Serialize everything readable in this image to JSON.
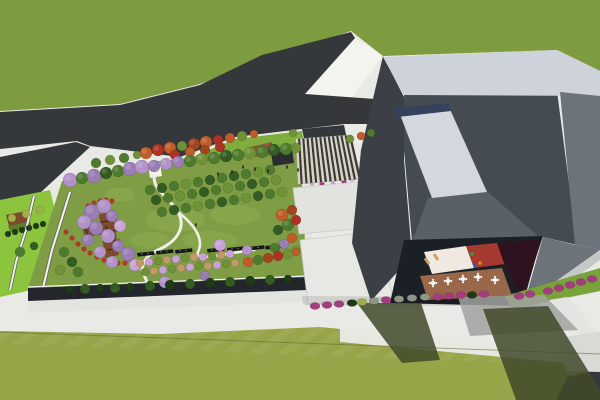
{
  "scene": {
    "palette": {
      "lawnTop": "#7d9b3f",
      "lawnBottom": "#8d9c40",
      "gardenLawn": "#7f9d45",
      "parkGreen": "#8cc43e",
      "stripGreen": "#7fae3f",
      "rightStripGreen": "#7aa23a",
      "road": "#35383b",
      "hardscape": "#e9e9e5",
      "brightPaving": "#f3f3ef",
      "path": "#f0efe8",
      "pathDark": "#5a5a56",
      "parapetDark": "#23272b",
      "wallLight": "#e3e4df",
      "buildingTop": "#cdd2db",
      "buildingFaceDark": "#3a4046",
      "buildingInner": "#454b53",
      "buildingSlope": "#6d737b",
      "underSkylight": "#5a6068",
      "skylight": "#d4d7de",
      "skylightStrip": "#34425d",
      "eave": "#c4c8c7",
      "courtyardSurround": "#1b2026",
      "courtyardWhite": "#efe9e2",
      "courtyardRed": "#a63a31",
      "courtyardMaroon": "#2e1220",
      "terraceBrown": "#99684a",
      "pergolaBrown": "#7c4c2a",
      "pergolaSlat": "#3a2414",
      "amphiBrown": "#8a5a34",
      "kioskDark": "#2a2d30",
      "canopyDark": "#3a3a38",
      "canopyLight": "#d8d4c4",
      "memorial": "#15181a",
      "shadowGrass": "#3f4a2a",
      "shadowPaving": "#a0a2a0",
      "tableWhite": "#f5f5f2",
      "loungerTan": "#c8a06a",
      "personDark": "#26262a",
      "flowerRed": "#b03226",
      "lawnPatch": "#93b052",
      "g1": "#4e7a2e",
      "g2": "#335c22",
      "g3": "#6f9138",
      "g4": "#9ab14e",
      "p1": "#9b7db6",
      "p2": "#b392c9",
      "pk": "#c9a2d8",
      "mg": "#a63c80",
      "o1": "#c05c28",
      "o2": "#a0441e",
      "rd": "#ae3224",
      "tn": "#c09a6a",
      "gy": "#8e9682",
      "yg": "#a2b04c",
      "hd": "#1e3a16"
    },
    "trees": [
      [
        96,
        163,
        5,
        "g1"
      ],
      [
        110,
        160,
        5,
        "g3"
      ],
      [
        124,
        158,
        5,
        "g1"
      ],
      [
        137,
        155,
        4,
        "g3"
      ],
      [
        146,
        153,
        6,
        "o1"
      ],
      [
        158,
        150,
        6,
        "rd"
      ],
      [
        170,
        148,
        6,
        "o1"
      ],
      [
        182,
        146,
        5,
        "g3"
      ],
      [
        194,
        144,
        6,
        "o2"
      ],
      [
        206,
        142,
        6,
        "o1"
      ],
      [
        218,
        140,
        5,
        "rd"
      ],
      [
        230,
        138,
        5,
        "o1"
      ],
      [
        242,
        136,
        5,
        "g3"
      ],
      [
        254,
        134,
        4,
        "o1"
      ],
      [
        175,
        155,
        5,
        "rd"
      ],
      [
        190,
        152,
        5,
        "o1"
      ],
      [
        205,
        150,
        5,
        "o2"
      ],
      [
        220,
        147,
        5,
        "rd"
      ],
      [
        293,
        133,
        4,
        "g3"
      ],
      [
        350,
        139,
        4,
        "g3"
      ],
      [
        361,
        136,
        4,
        "o1"
      ],
      [
        371,
        133,
        4,
        "g1"
      ],
      [
        70,
        180,
        7,
        "p2"
      ],
      [
        82,
        178,
        6,
        "g1"
      ],
      [
        94,
        176,
        7,
        "p1"
      ],
      [
        106,
        173,
        6,
        "g2"
      ],
      [
        118,
        171,
        6,
        "g1"
      ],
      [
        130,
        169,
        7,
        "p1"
      ],
      [
        142,
        167,
        7,
        "p2"
      ],
      [
        154,
        166,
        6,
        "p1"
      ],
      [
        166,
        164,
        6,
        "p2"
      ],
      [
        178,
        162,
        6,
        "p1"
      ],
      [
        190,
        161,
        6,
        "g1"
      ],
      [
        202,
        159,
        6,
        "g3"
      ],
      [
        214,
        158,
        6,
        "g1"
      ],
      [
        226,
        156,
        6,
        "g2"
      ],
      [
        238,
        155,
        6,
        "g1"
      ],
      [
        250,
        153,
        6,
        "g3"
      ],
      [
        262,
        152,
        6,
        "g1"
      ],
      [
        274,
        150,
        6,
        "g2"
      ],
      [
        286,
        149,
        6,
        "g1"
      ],
      [
        296,
        148,
        5,
        "g3"
      ],
      [
        150,
        190,
        5,
        "g1"
      ],
      [
        162,
        188,
        5,
        "g2"
      ],
      [
        174,
        186,
        5,
        "g1"
      ],
      [
        186,
        184,
        5,
        "g3"
      ],
      [
        198,
        182,
        5,
        "g1"
      ],
      [
        210,
        180,
        5,
        "g2"
      ],
      [
        222,
        178,
        5,
        "g1"
      ],
      [
        234,
        176,
        5,
        "g2"
      ],
      [
        246,
        174,
        5,
        "g1"
      ],
      [
        258,
        172,
        5,
        "g3"
      ],
      [
        270,
        170,
        5,
        "g1"
      ],
      [
        156,
        200,
        5,
        "g2"
      ],
      [
        168,
        198,
        5,
        "g1"
      ],
      [
        180,
        196,
        5,
        "g3"
      ],
      [
        192,
        194,
        5,
        "g1"
      ],
      [
        204,
        192,
        5,
        "g2"
      ],
      [
        216,
        190,
        5,
        "g1"
      ],
      [
        228,
        188,
        5,
        "g3"
      ],
      [
        240,
        186,
        5,
        "g1"
      ],
      [
        252,
        184,
        5,
        "g2"
      ],
      [
        264,
        182,
        5,
        "g1"
      ],
      [
        276,
        180,
        5,
        "g3"
      ],
      [
        162,
        212,
        5,
        "g1"
      ],
      [
        174,
        210,
        5,
        "g2"
      ],
      [
        186,
        208,
        5,
        "g1"
      ],
      [
        198,
        206,
        5,
        "g3"
      ],
      [
        210,
        204,
        5,
        "g1"
      ],
      [
        222,
        202,
        5,
        "g2"
      ],
      [
        234,
        200,
        5,
        "g1"
      ],
      [
        246,
        198,
        5,
        "g3"
      ],
      [
        258,
        196,
        5,
        "g2"
      ],
      [
        270,
        194,
        5,
        "g1"
      ],
      [
        282,
        192,
        5,
        "g3"
      ],
      [
        282,
        215,
        6,
        "o1"
      ],
      [
        292,
        210,
        5,
        "o2"
      ],
      [
        288,
        225,
        6,
        "g1"
      ],
      [
        296,
        220,
        5,
        "rd"
      ],
      [
        278,
        230,
        5,
        "g2"
      ],
      [
        292,
        238,
        5,
        "o1"
      ],
      [
        284,
        244,
        5,
        "p1"
      ],
      [
        296,
        250,
        4,
        "g3"
      ],
      [
        275,
        248,
        5,
        "g1"
      ],
      [
        92,
        212,
        8,
        "p1"
      ],
      [
        104,
        206,
        7,
        "p2"
      ],
      [
        84,
        222,
        7,
        "p2"
      ],
      [
        112,
        216,
        6,
        "p1"
      ],
      [
        96,
        228,
        7,
        "p1"
      ],
      [
        120,
        226,
        6,
        "pk"
      ],
      [
        108,
        236,
        7,
        "p2"
      ],
      [
        88,
        240,
        6,
        "p1"
      ],
      [
        118,
        246,
        6,
        "p1"
      ],
      [
        100,
        252,
        6,
        "p2"
      ],
      [
        128,
        254,
        7,
        "p1"
      ],
      [
        112,
        262,
        6,
        "p2"
      ],
      [
        135,
        265,
        6,
        "pk"
      ],
      [
        64,
        252,
        5,
        "g1"
      ],
      [
        72,
        262,
        5,
        "g2"
      ],
      [
        60,
        270,
        5,
        "g3"
      ],
      [
        78,
        272,
        5,
        "g1"
      ],
      [
        140,
        263,
        4,
        "tn"
      ],
      [
        149,
        262,
        4,
        "pk"
      ],
      [
        158,
        261,
        4,
        "g3"
      ],
      [
        167,
        260,
        4,
        "tn"
      ],
      [
        176,
        259,
        4,
        "pk"
      ],
      [
        185,
        258,
        4,
        "g3"
      ],
      [
        194,
        257,
        4,
        "tn"
      ],
      [
        203,
        257,
        4,
        "pk"
      ],
      [
        212,
        256,
        4,
        "g3"
      ],
      [
        221,
        255,
        4,
        "tn"
      ],
      [
        230,
        254,
        4,
        "pk"
      ],
      [
        145,
        272,
        4,
        "g3"
      ],
      [
        154,
        271,
        4,
        "tn"
      ],
      [
        163,
        270,
        4,
        "pk"
      ],
      [
        172,
        269,
        4,
        "g3"
      ],
      [
        181,
        268,
        4,
        "tn"
      ],
      [
        190,
        267,
        4,
        "pk"
      ],
      [
        199,
        266,
        4,
        "g3"
      ],
      [
        208,
        266,
        4,
        "tn"
      ],
      [
        217,
        265,
        4,
        "pk"
      ],
      [
        226,
        264,
        4,
        "g3"
      ],
      [
        235,
        263,
        4,
        "tn"
      ],
      [
        248,
        262,
        5,
        "o1"
      ],
      [
        258,
        260,
        5,
        "g1"
      ],
      [
        268,
        258,
        5,
        "o2"
      ],
      [
        278,
        256,
        5,
        "rd"
      ],
      [
        288,
        254,
        5,
        "g3"
      ],
      [
        296,
        252,
        4,
        "o1"
      ],
      [
        165,
        282,
        6,
        "p2"
      ],
      [
        205,
        276,
        5,
        "p1"
      ],
      [
        220,
        245,
        6,
        "pk"
      ],
      [
        247,
        250,
        5,
        "p2"
      ],
      [
        70,
        290,
        4,
        "hd"
      ],
      [
        85,
        289,
        5,
        "g2"
      ],
      [
        100,
        288,
        4,
        "hd"
      ],
      [
        115,
        288,
        5,
        "g2"
      ],
      [
        130,
        287,
        4,
        "hd"
      ],
      [
        150,
        286,
        5,
        "g2"
      ],
      [
        170,
        285,
        5,
        "hd"
      ],
      [
        190,
        284,
        5,
        "g2"
      ],
      [
        210,
        283,
        5,
        "hd"
      ],
      [
        230,
        282,
        5,
        "g2"
      ],
      [
        250,
        281,
        5,
        "hd"
      ],
      [
        270,
        280,
        5,
        "g2"
      ],
      [
        288,
        279,
        4,
        "hd"
      ],
      [
        20,
        252,
        5,
        "g1"
      ],
      [
        34,
        246,
        4,
        "g2"
      ],
      [
        12,
        218,
        4,
        "yg"
      ],
      [
        8,
        234,
        3,
        "hd"
      ],
      [
        15,
        232,
        3,
        "hd"
      ],
      [
        22,
        230,
        3,
        "hd"
      ],
      [
        29,
        228,
        3,
        "hd"
      ],
      [
        36,
        226,
        3,
        "hd"
      ],
      [
        43,
        224,
        3,
        "hd"
      ],
      [
        26,
        214,
        4,
        "yg"
      ],
      [
        40,
        210,
        4,
        "yg"
      ]
    ],
    "apron_shrubs": [
      [
        315,
        306,
        "mg"
      ],
      [
        327,
        305,
        "mg"
      ],
      [
        339,
        304,
        "mg"
      ],
      [
        352,
        303,
        "hd"
      ],
      [
        362,
        302,
        "yg"
      ],
      [
        374,
        301,
        "gy"
      ],
      [
        386,
        300,
        "mg"
      ],
      [
        399,
        299,
        "gy"
      ],
      [
        412,
        298,
        "gy"
      ],
      [
        425,
        297,
        "gy"
      ],
      [
        438,
        297,
        "mg"
      ],
      [
        449,
        296,
        "mg"
      ],
      [
        461,
        295,
        "mg"
      ],
      [
        472,
        295,
        "hd"
      ],
      [
        484,
        294,
        "mg"
      ],
      [
        519,
        296,
        "mg"
      ],
      [
        530,
        294,
        "mg"
      ],
      [
        548,
        291,
        "mg"
      ],
      [
        559,
        288,
        "mg"
      ],
      [
        570,
        285,
        "mg"
      ],
      [
        581,
        282,
        "mg"
      ],
      [
        592,
        279,
        "mg"
      ]
    ],
    "memorial_walls": [
      [
        137,
        253
      ],
      [
        156,
        251
      ],
      [
        175,
        250
      ],
      [
        207,
        249
      ],
      [
        227,
        248
      ],
      [
        247,
        247
      ],
      [
        265,
        246
      ]
    ],
    "canopy": {
      "tl": [
        296,
        139
      ],
      "tr": [
        351,
        135
      ],
      "br": [
        361,
        179
      ],
      "bl": [
        298,
        184
      ],
      "stripes": 26
    },
    "tables": [
      [
        433,
        283
      ],
      [
        448,
        281
      ],
      [
        463,
        279
      ],
      [
        478,
        277
      ],
      [
        495,
        280
      ]
    ],
    "loungers": [
      [
        427,
        261
      ],
      [
        436,
        257
      ]
    ],
    "people_plaza": [
      [
        243,
        167
      ],
      [
        255,
        169
      ],
      [
        268,
        171
      ],
      [
        287,
        167
      ],
      [
        298,
        170
      ],
      [
        232,
        172
      ],
      [
        218,
        174
      ],
      [
        196,
        225
      ]
    ],
    "people_courtyard": [
      [
        472,
        254,
        "#3aa03a"
      ],
      [
        477,
        258,
        "#c03030"
      ],
      [
        480,
        263,
        "#d89020"
      ],
      [
        475,
        266,
        "#3558b8"
      ]
    ],
    "flowers_red": [
      [
        66,
        232
      ],
      [
        72,
        238
      ],
      [
        78,
        244
      ],
      [
        84,
        249
      ],
      [
        90,
        253
      ],
      [
        97,
        257
      ],
      [
        104,
        260
      ],
      [
        111,
        262
      ],
      [
        118,
        263
      ],
      [
        125,
        263
      ],
      [
        132,
        262
      ],
      [
        88,
        206
      ],
      [
        94,
        203
      ],
      [
        100,
        201
      ],
      [
        106,
        200
      ],
      [
        112,
        201
      ]
    ],
    "flowers_canopy": [
      [
        303,
        181,
        "mg"
      ],
      [
        312,
        183,
        "pk"
      ],
      [
        322,
        184,
        "mg"
      ],
      [
        333,
        184,
        "pk"
      ],
      [
        344,
        182,
        "mg"
      ],
      [
        352,
        179,
        "pk"
      ]
    ],
    "lawn_patches": [
      [
        175,
        220,
        30,
        12
      ],
      [
        235,
        215,
        25,
        10
      ],
      [
        150,
        240,
        20,
        8
      ],
      [
        210,
        240,
        28,
        9
      ],
      [
        120,
        195,
        15,
        7
      ]
    ]
  }
}
